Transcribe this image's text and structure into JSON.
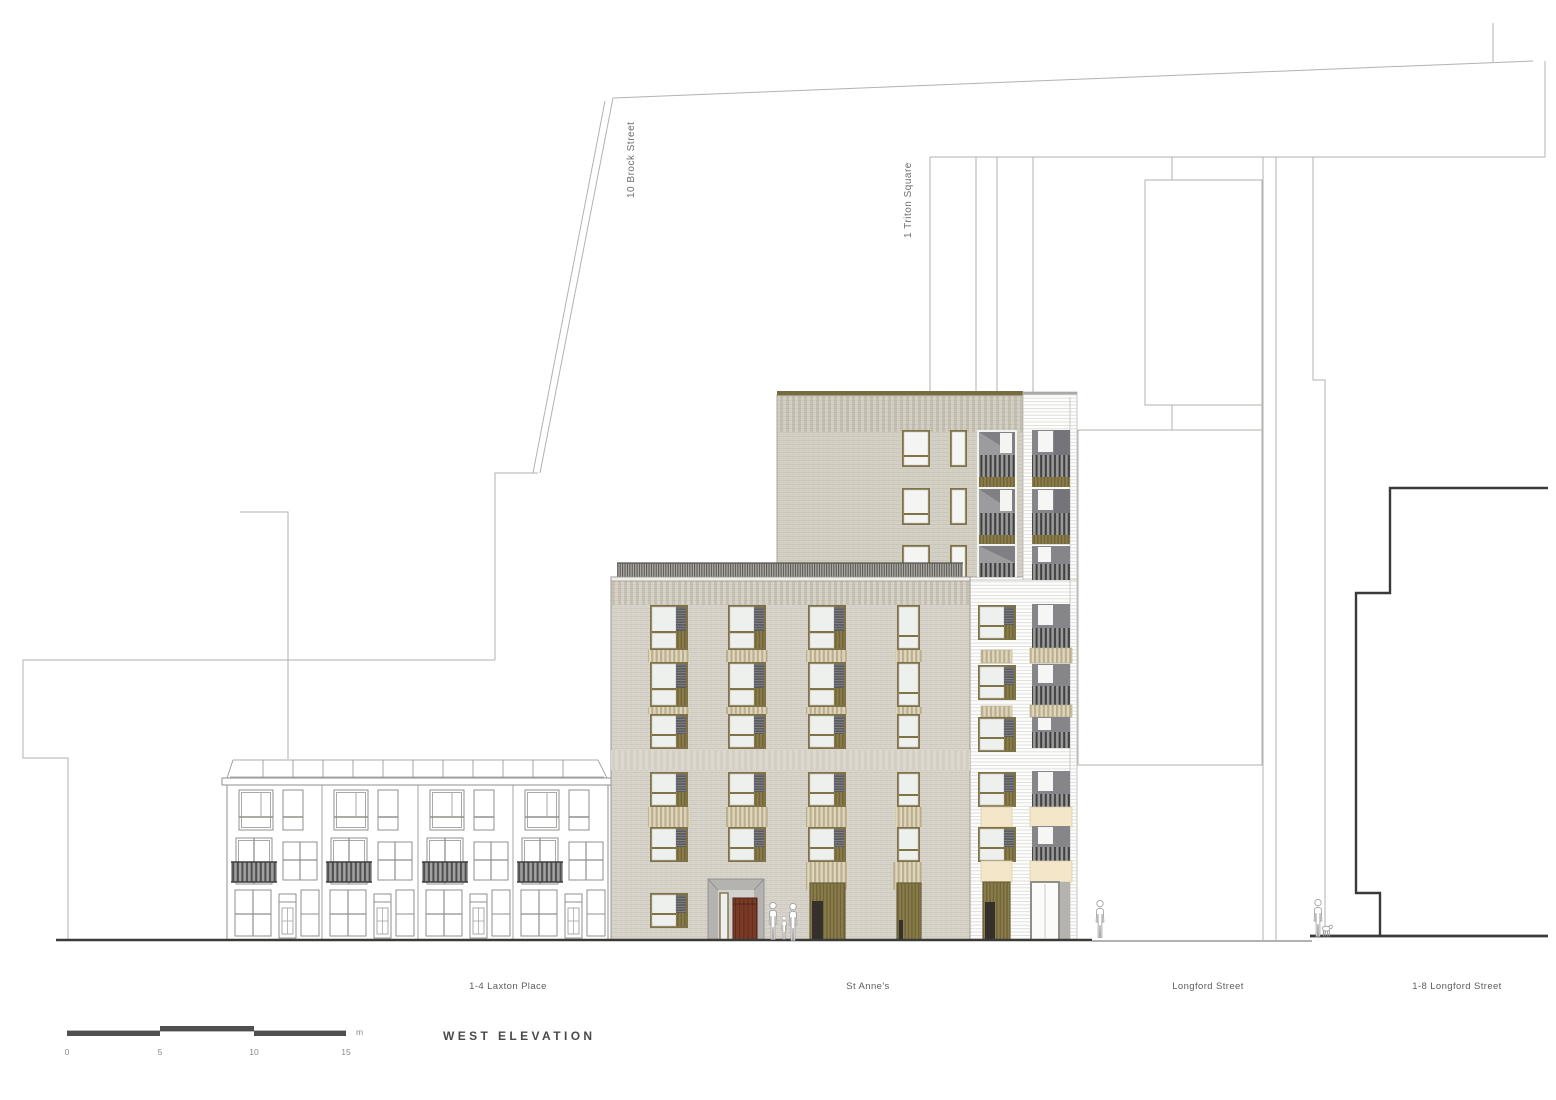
{
  "drawing": {
    "title": "WEST ELEVATION",
    "building_labels": {
      "brock_street": "10 Brock Street",
      "triton_square": "1 Triton Square",
      "laxton_place": "1-4 Laxton Place",
      "st_annes": "St Anne's",
      "longford_street": "Longford Street",
      "longford_terrace": "1-8 Longford Street"
    },
    "scale_bar": {
      "ticks": [
        "0",
        "5",
        "10",
        "15"
      ],
      "unit": "m"
    },
    "colors": {
      "line-thin": "#b5b2ae",
      "line-mid": "#8f8f8c",
      "line-dark": "#3a3a38",
      "brick-low": "#d8d4cb",
      "brick-up": "#d5d0c5",
      "olive": "#7e7246",
      "olive-slat": "#8b7d4a",
      "glass": "#eef0ee",
      "louvre": "#5b5c60",
      "cream": "#f3e6c9",
      "spandrel": "#b9ae90",
      "bars": "#3d3e40",
      "soffit": "#9c9c9e",
      "recess": "#85858a",
      "door-red": "#7a3a26",
      "entry-grey": "#b4b3af",
      "white-line": "#d9d9d6",
      "text": "#5d5d5d"
    }
  }
}
